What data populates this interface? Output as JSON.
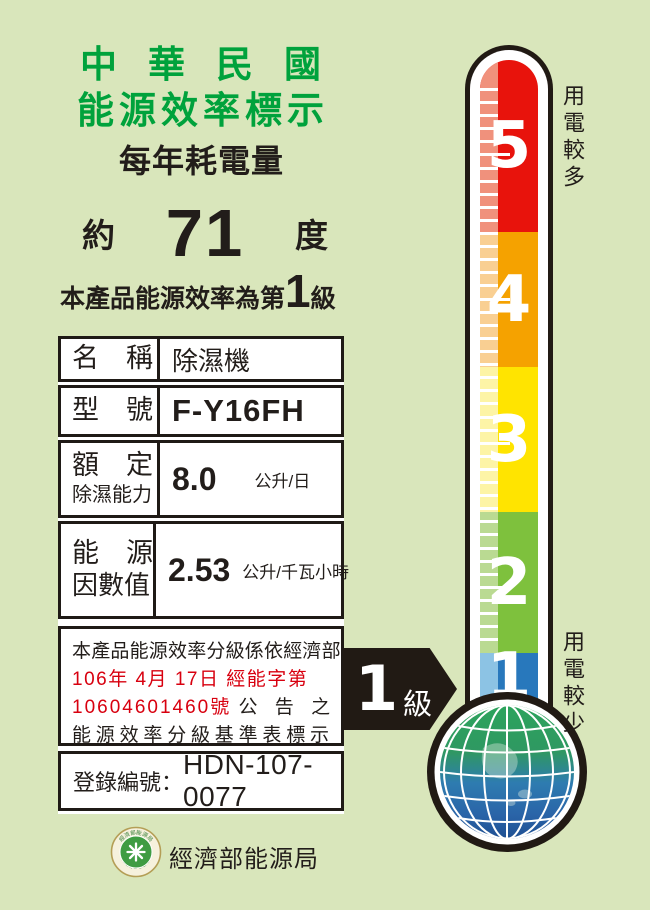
{
  "header": {
    "title_line1": "中華民國",
    "title_line2": "能源效率標示",
    "subtitle": "每年耗電量"
  },
  "consumption": {
    "prefix": "約",
    "value": "71",
    "unit": "度"
  },
  "grade": {
    "prefix": "本產品能源效率為第",
    "value": "1",
    "suffix": "級"
  },
  "spec_table": {
    "rows": [
      {
        "label": "名　稱",
        "value": "除濕機"
      },
      {
        "label": "型　號",
        "value": "F-Y16FH"
      },
      {
        "label_line1": "額　定",
        "label_line2": "除濕能力",
        "value": "8.0",
        "unit": "公升/日"
      },
      {
        "label_line1": "能　源",
        "label_line2": "因數值",
        "value": "2.53",
        "unit": "公升/千瓦小時"
      }
    ]
  },
  "notice": {
    "line1": "本產品能源效率分級係依經濟部",
    "line2_red": "106年 4月 17日 經能字第",
    "line3_red": "10604601460號",
    "line3_black": "公 告 之",
    "line4": "能源效率分級基準表標示"
  },
  "registration": {
    "label": "登錄編號：",
    "number": "HDN-107-0077"
  },
  "footer": {
    "agency": "經濟部能源局",
    "seal_ring_top": "經濟部能源局",
    "seal_ring_bottom": "BUREAU OF ENERGY"
  },
  "thermometer": {
    "note_more": "用電較多",
    "note_less": "用電較少",
    "levels": [
      {
        "value": "5",
        "color": "#e8130c",
        "light": "#f0917c"
      },
      {
        "value": "4",
        "color": "#f5a200",
        "light": "#f9cf92"
      },
      {
        "value": "3",
        "color": "#ffe400",
        "light": "#fdf4a6"
      },
      {
        "value": "2",
        "color": "#7ec13d",
        "light": "#bada92"
      },
      {
        "value": "1",
        "color": "#2878bc",
        "light": "#8cc3e4"
      }
    ],
    "pointer_value": "1",
    "pointer_suffix": "級"
  },
  "colors": {
    "background": "#d9e6bb",
    "title_green": "#00a23c",
    "ink": "#221d1a",
    "accent_red": "#d8000f",
    "paper": "#ffffff",
    "border_black": "#1f1a16",
    "arrow_black": "#211a14",
    "tick_white": "#ffffff",
    "globe_top_green": "#2ca45c",
    "globe_mid_blue": "#2e7cb0",
    "globe_bottom_blue": "#1e4f92",
    "globe_grid": "#ffffff"
  }
}
